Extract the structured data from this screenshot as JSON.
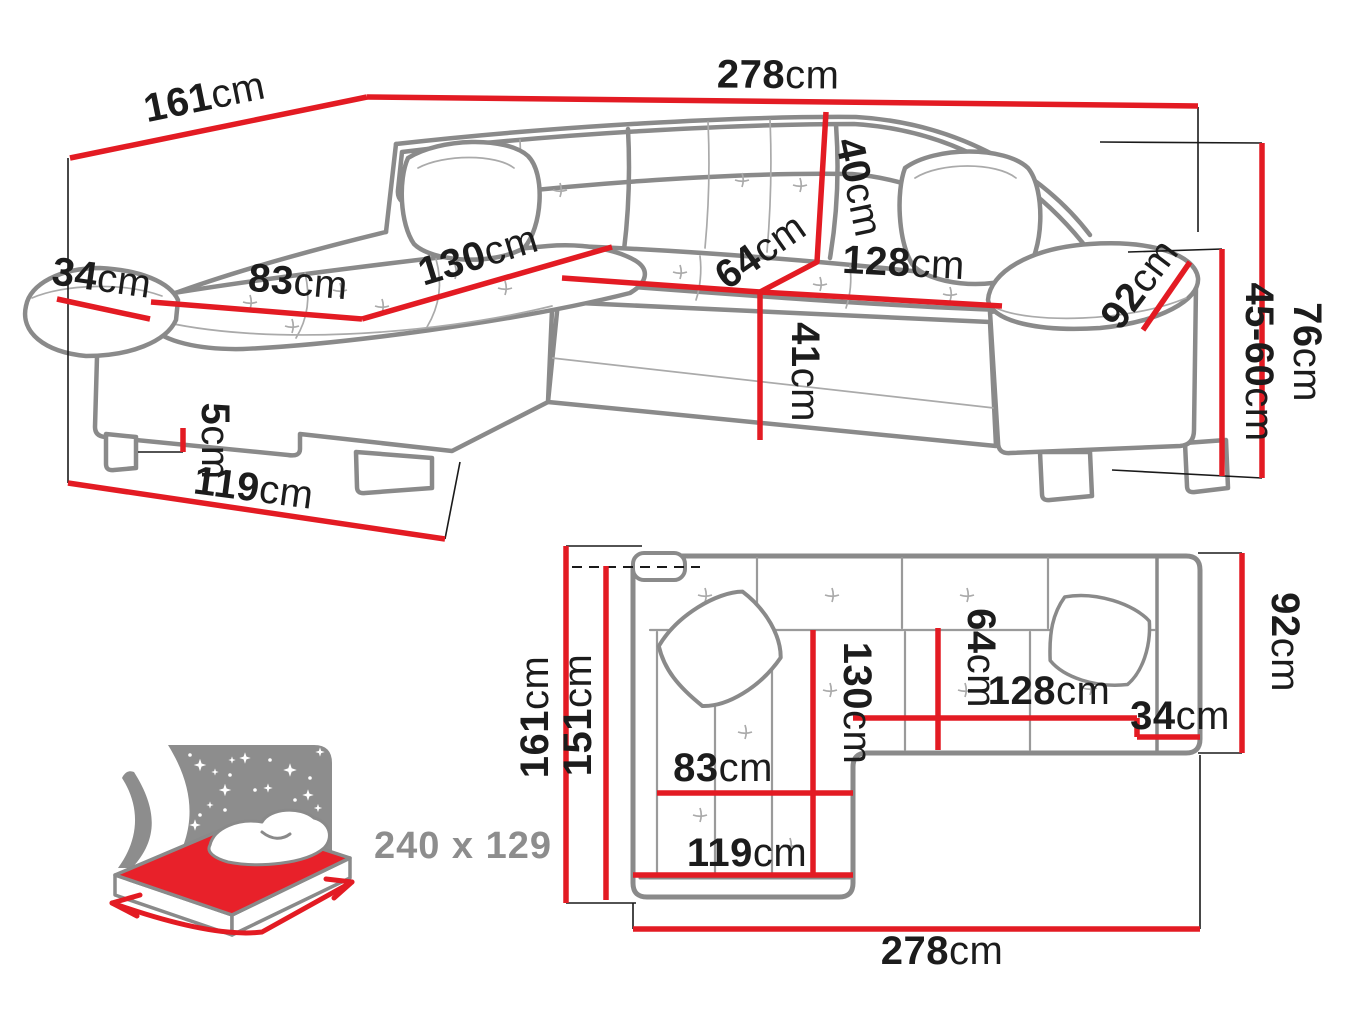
{
  "perspective_view": {
    "back_width": {
      "v": "278",
      "u": "cm"
    },
    "side_depth": {
      "v": "161",
      "u": "cm"
    },
    "armrest_front_width": {
      "v": "34",
      "u": "cm"
    },
    "chaise_seat_width": {
      "v": "83",
      "u": "cm"
    },
    "chaise_seat_length": {
      "v": "130",
      "u": "cm"
    },
    "backrest_height": {
      "v": "40",
      "u": "cm"
    },
    "seat_depth": {
      "v": "64",
      "u": "cm"
    },
    "seat_width": {
      "v": "128",
      "u": "cm"
    },
    "armrest_length": {
      "v": "92",
      "u": "cm"
    },
    "seat_height": {
      "v": "41",
      "u": "cm"
    },
    "leg_height": {
      "v": "5",
      "u": "cm"
    },
    "chaise_front_width": {
      "v": "119",
      "u": "cm"
    },
    "total_height": {
      "v": "76",
      "u": "cm"
    },
    "armrest_height": {
      "v": "45-60",
      "u": "cm"
    }
  },
  "plan_view": {
    "total_depth": {
      "v": "161",
      "u": "cm"
    },
    "inner_depth": {
      "v": "151",
      "u": "cm"
    },
    "chaise_length": {
      "v": "130",
      "u": "cm"
    },
    "seat_depth": {
      "v": "64",
      "u": "cm"
    },
    "seat_width": {
      "v": "128",
      "u": "cm"
    },
    "armrest_width": {
      "v": "34",
      "u": "cm"
    },
    "armrest_length": {
      "v": "92",
      "u": "cm"
    },
    "chaise_seat_width": {
      "v": "83",
      "u": "cm"
    },
    "chaise_front_width": {
      "v": "119",
      "u": "cm"
    },
    "total_width": {
      "v": "278",
      "u": "cm"
    }
  },
  "sleeping_function": {
    "bed_size": "240 x 129"
  },
  "colors": {
    "dimension_red": "#e31b23",
    "outline_gray": "#8a8a8a",
    "text_dark": "#1c1c1c",
    "icon_gray": "#8d8d8d"
  }
}
